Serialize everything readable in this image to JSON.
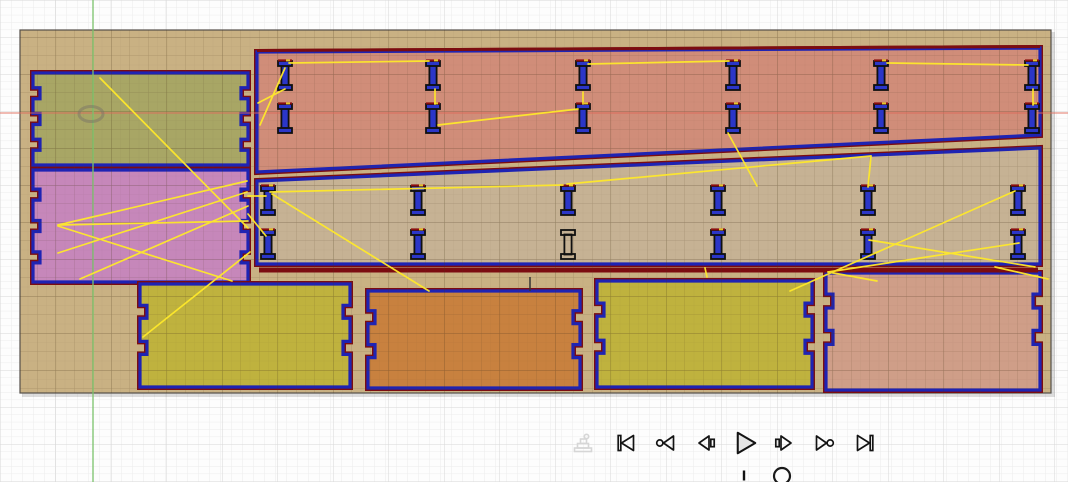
{
  "window": {
    "width": 1068,
    "height": 482,
    "view": "cam-simulation-viewport"
  },
  "palette": {
    "page_background": "#fdfdfd",
    "grid_minor": "#ececec",
    "grid_major": "#d8d8d8",
    "stock_fill": "#c9b183",
    "stock_grid": "rgba(80,58,28,0.14)",
    "panel_outline_blue": "#1e23b4",
    "panel_outline_maroon": "#7c0c10",
    "clip_fill_blue": "#2b36c8",
    "rapid_yellow": "#ffe92a",
    "axis_red": "#e06a5a",
    "axis_green": "#7cc46c",
    "icon_ink": "#141414",
    "icon_ghost": "#d6d6d6"
  },
  "grid": {
    "page_minor_x": 11,
    "page_minor_y": 7.4,
    "page_major_x": 55.5,
    "page_major_y": 37,
    "stock_fine": 9.25,
    "stock_medium": 18.5
  },
  "axes": {
    "x_axis": {
      "y": 113
    },
    "y_axis": {
      "x": 93
    }
  },
  "stock": {
    "x": 20,
    "y": 30,
    "width": 1031,
    "height": 363
  },
  "panels": [
    {
      "name": "panel-olive-left",
      "shape": "rect",
      "rect": [
        33,
        73,
        215,
        92
      ],
      "fill": "#a8a665",
      "notch_fracs": [
        0.22,
        0.5,
        0.78
      ],
      "notch_depth": 7,
      "notch_height": 11
    },
    {
      "name": "panel-pink-left",
      "shape": "rect",
      "rect": [
        33,
        170,
        215,
        112
      ],
      "fill": "#c687ba",
      "notch_fracs": [
        0.22,
        0.5,
        0.78
      ],
      "notch_depth": 7,
      "notch_height": 11
    },
    {
      "name": "panel-salmon-rail",
      "shape": "quad",
      "points": [
        [
          257,
          52
        ],
        [
          1040,
          48
        ],
        [
          1040,
          135
        ],
        [
          257,
          172
        ]
      ],
      "fill": "#d08d79"
    },
    {
      "name": "panel-tan-rail",
      "shape": "quad",
      "points": [
        [
          257,
          181
        ],
        [
          1040,
          148
        ],
        [
          1040,
          264
        ],
        [
          257,
          264
        ]
      ],
      "fill": "#c6b294"
    },
    {
      "name": "panel-yellow-bottom-1",
      "shape": "rect",
      "rect": [
        140,
        284,
        210,
        103
      ],
      "fill": "#bfb23e",
      "notch_fracs": [
        0.27,
        0.62
      ],
      "notch_depth": 7,
      "notch_height": 13
    },
    {
      "name": "panel-orange-bottom",
      "shape": "rect",
      "rect": [
        368,
        291,
        212,
        97
      ],
      "fill": "#c8813f",
      "notch_fracs": [
        0.27,
        0.62
      ],
      "notch_depth": 7,
      "notch_height": 13
    },
    {
      "name": "panel-yellow-bottom-2",
      "shape": "rect",
      "rect": [
        597,
        281,
        215,
        106
      ],
      "fill": "#bfb23e",
      "notch_fracs": [
        0.27,
        0.62
      ],
      "notch_depth": 7,
      "notch_height": 13
    },
    {
      "name": "panel-dusty-bottom",
      "shape": "rect",
      "rect": [
        826,
        273,
        214,
        117
      ],
      "fill": "#cf9e88",
      "notch_fracs": [
        0.24,
        0.55
      ],
      "notch_depth": 7,
      "notch_height": 14
    }
  ],
  "small_parts": {
    "width": 14,
    "height": 29,
    "groups": [
      {
        "name": "top-rail-clips",
        "columns": [
          285,
          433,
          583,
          733,
          881,
          1032
        ],
        "row_tops": [
          61,
          104
        ],
        "uncut": []
      },
      {
        "name": "mid-rail-clips",
        "columns": [
          268,
          418,
          568,
          718,
          868,
          1018
        ],
        "row_tops": [
          186,
          230
        ],
        "uncut": [
          [
            2,
            1
          ]
        ]
      }
    ]
  },
  "rapid_moves": {
    "segments": [
      [
        289,
        63,
        429,
        61
      ],
      [
        588,
        64,
        729,
        61
      ],
      [
        887,
        63,
        1028,
        65
      ],
      [
        435,
        89,
        435,
        104
      ],
      [
        583,
        92,
        583,
        104
      ],
      [
        1033,
        89,
        1033,
        105
      ],
      [
        438,
        125,
        578,
        109
      ],
      [
        728,
        133,
        757,
        186
      ],
      [
        100,
        78,
        248,
        228
      ],
      [
        285,
        89,
        258,
        103
      ],
      [
        285,
        68,
        260,
        125
      ],
      [
        248,
        196,
        266,
        196
      ],
      [
        248,
        214,
        266,
        236
      ],
      [
        58,
        225,
        247,
        181
      ],
      [
        58,
        225,
        248,
        221
      ],
      [
        58,
        226,
        232,
        281
      ],
      [
        58,
        253,
        247,
        192
      ],
      [
        80,
        279,
        248,
        206
      ],
      [
        250,
        252,
        143,
        337
      ],
      [
        270,
        192,
        563,
        185
      ],
      [
        567,
        184,
        871,
        156
      ],
      [
        871,
        156,
        868,
        187
      ],
      [
        272,
        194,
        429,
        291
      ],
      [
        790,
        291,
        1015,
        191
      ],
      [
        869,
        240,
        1035,
        267
      ],
      [
        1019,
        243,
        828,
        272
      ],
      [
        828,
        272,
        877,
        281
      ],
      [
        995,
        267,
        1048,
        279
      ],
      [
        705,
        268,
        707,
        277
      ]
    ]
  },
  "misc_marks": {
    "mid_rail_bottom_line": {
      "x1": 259,
      "y": 270,
      "x2": 1038
    },
    "plunge_tick": [
      530,
      277,
      530,
      291
    ]
  },
  "tool_marker": {
    "x": 91,
    "y": 114
  },
  "playback": {
    "buttons": [
      {
        "name": "simulate-machine-toggle",
        "icon": "machine-icon",
        "disabled": true
      },
      {
        "name": "go-to-start",
        "icon": "skip-to-start-icon"
      },
      {
        "name": "previous-operation",
        "icon": "prev-operation-icon"
      },
      {
        "name": "step-back",
        "icon": "step-back-icon"
      },
      {
        "name": "play",
        "icon": "play-icon"
      },
      {
        "name": "step-forward",
        "icon": "step-forward-icon"
      },
      {
        "name": "next-operation",
        "icon": "next-operation-icon"
      },
      {
        "name": "go-to-end",
        "icon": "skip-to-end-icon"
      }
    ],
    "toolbar": {
      "centers_x": [
        583,
        626,
        666,
        707,
        745,
        783,
        824,
        865
      ],
      "center_y": 443,
      "icon_size": 24,
      "play_size": 29
    },
    "slider": {
      "y": 476,
      "x_start": 560,
      "x_end": 905,
      "tick_x": 744,
      "thumb_x": 782,
      "thumb_r": 8
    }
  }
}
